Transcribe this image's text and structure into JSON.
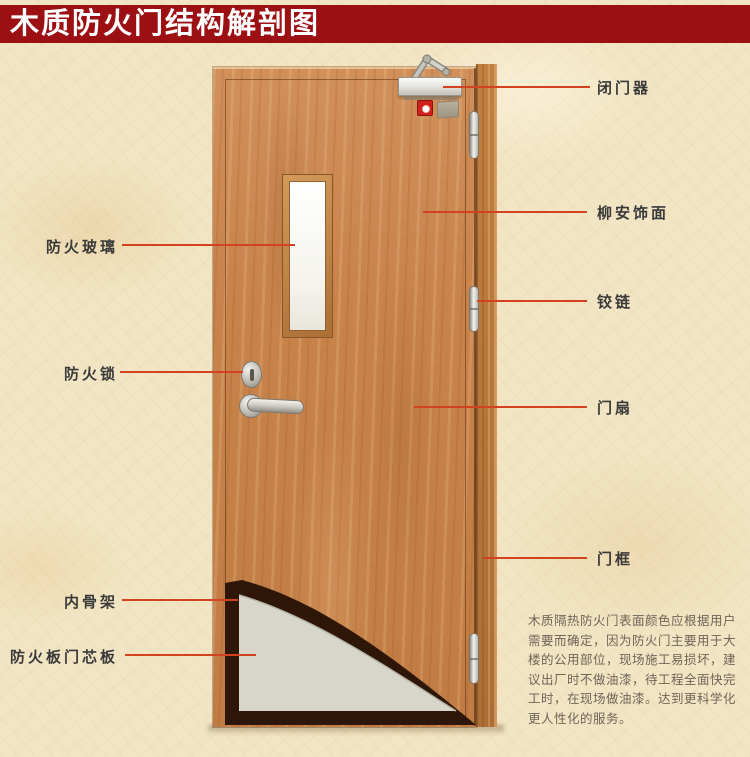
{
  "page": {
    "title": "木质防火门结构解剖图"
  },
  "colors": {
    "banner_red": "#9c1013",
    "callout_red": "#d2421f",
    "door_wood": "#c8834b",
    "frame_wood": "#b5763a",
    "glass_white": "#f7f6f0",
    "core_gray": "#d8d5cb",
    "skeleton_dark": "#2e1708",
    "background_beige": "#f2e5c4",
    "label_text": "#3a3a3a",
    "note_text": "#6e6557"
  },
  "diagram": {
    "labels_left": [
      {
        "text": "防火玻璃"
      },
      {
        "text": "防火锁"
      },
      {
        "text": "内骨架"
      },
      {
        "text": "防火板门芯板"
      }
    ],
    "labels_right": [
      {
        "text": "闭门器"
      },
      {
        "text": "柳安饰面"
      },
      {
        "text": "铰链"
      },
      {
        "text": "门扇"
      },
      {
        "text": "门框"
      }
    ]
  },
  "note": {
    "lines": [
      "木质隔热防火门表面颜色应根据用户",
      "需要而确定，因为防火门主要用于大",
      "楼的公用部位，现场施工易损坏，建",
      "议出厂时不做油漆，待工程全面快完",
      "工时，在现场做油漆。达到更科学化",
      "更人性化的服务。"
    ]
  }
}
